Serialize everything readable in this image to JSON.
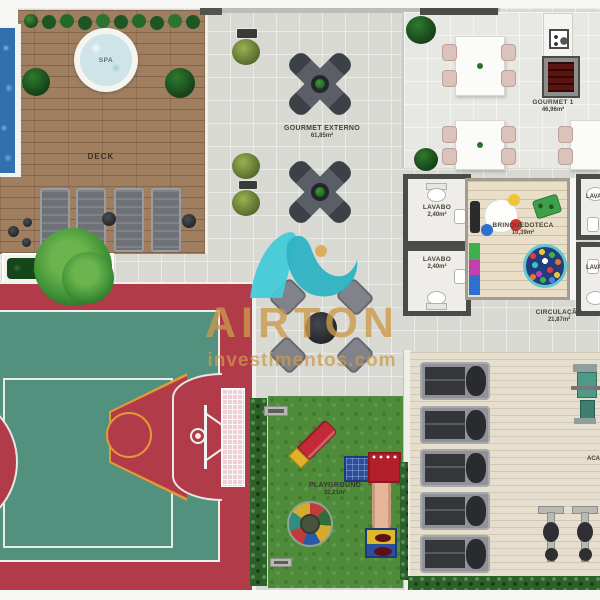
{
  "watermark": {
    "brand": "AIRTON",
    "site": "investimentos.com",
    "gold": "#cb9a4c",
    "teal": "#3fc6d6"
  },
  "rooms": {
    "spa": {
      "label": "SPA"
    },
    "deck": {
      "label": "DECK"
    },
    "gourmet_externo": {
      "label": "GOURMET EXTERNO",
      "area": "61,85m²"
    },
    "gourmet_1": {
      "label": "GOURMET 1",
      "area": "46,96m²"
    },
    "lavabo_1": {
      "label": "LAVABO",
      "area": "2,40m²"
    },
    "lavabo_2": {
      "label": "LAVABO",
      "area": "2,40m²"
    },
    "lavabo_3": {
      "label": "LAVABO"
    },
    "lavabo_4": {
      "label": "LAVABO"
    },
    "brinquedoteca": {
      "label": "BRINQUEDOTECA",
      "area": "10,39m²"
    },
    "circulacao": {
      "label": "CIRCULAÇÃO",
      "area": "21,87m²"
    },
    "playground": {
      "label": "PLAYGROUND",
      "area": "32,21m²"
    },
    "academia": {
      "label": "ACADEMIA"
    }
  },
  "colors": {
    "court_red": "#b13b49",
    "court_green": "#53917f",
    "deck_wood": "#a07f60",
    "grass_green": "#4e8c3a",
    "floor_gray": "#d9d9d3"
  }
}
